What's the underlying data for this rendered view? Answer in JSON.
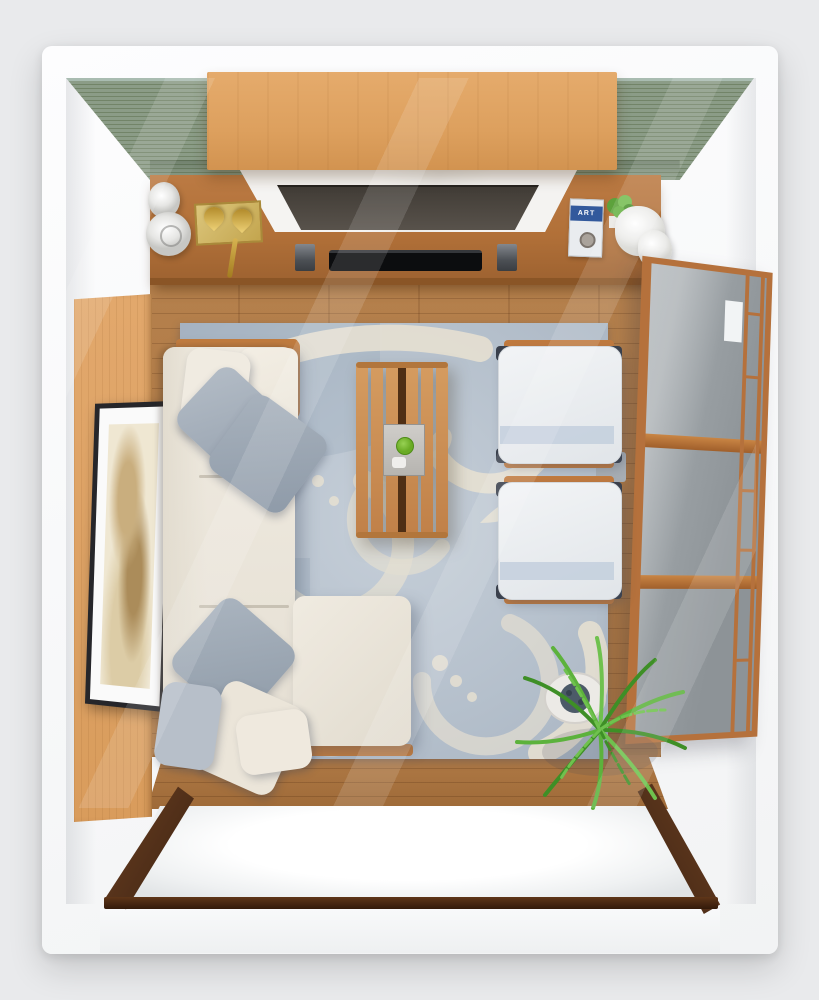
{
  "view": {
    "type": "3d-top-down-room-render",
    "room": "living-room"
  },
  "palette": {
    "background": "#e9eaec",
    "wall_white": "#f7f8f9",
    "green_wall": "#8b9c87",
    "wood_panel_light": "#e2a86c",
    "wood_console": "#b17038",
    "wood_floor": "#b5804c",
    "wood_table": "#d59c60",
    "wood_dark_frame": "#4a2a14",
    "marble_white": "#f3f2f0",
    "tv_screen": "#413c36",
    "soundbar_black": "#0c0d0f",
    "rug_base": "#b4bfcb",
    "rug_motif": "#e9e2d2",
    "sofa_cream": "#f0ebe1",
    "pillow_gray": "#a8b2bd",
    "chair_white": "#f2f4f6",
    "chair_stripe": "#c3cfdd",
    "shoji_frame": "#b5713c",
    "shoji_glass": "#9aa0a4",
    "plant_green": "#57ab35",
    "gold_brass": "#c9a43c",
    "art_sepia": "#c9ae7e",
    "pot_white": "#eceae6"
  },
  "scene": {
    "walls": {
      "back_wall_finish": "green ribbed paneling",
      "left_wall_finish": "white with oak slat paneling and framed art",
      "right_wall_finish": "white with shoji glass door"
    },
    "tv_console": {
      "book_title": "ART",
      "items": [
        "ceramic jug",
        "ceramic vase",
        "brass candle tray",
        "tv on marble slab",
        "soundbar",
        "speakers",
        "art book",
        "potted plant",
        "towel"
      ]
    },
    "furniture": [
      {
        "name": "sectional-sofa",
        "color_key": "sofa_cream"
      },
      {
        "name": "slatted-coffee-table",
        "color_key": "wood_table"
      },
      {
        "name": "armchair-top",
        "color_key": "chair_white"
      },
      {
        "name": "armchair-bottom",
        "color_key": "chair_white"
      },
      {
        "name": "area-rug",
        "color_key": "rug_base"
      },
      {
        "name": "palm-plant",
        "color_key": "plant_green"
      }
    ]
  }
}
